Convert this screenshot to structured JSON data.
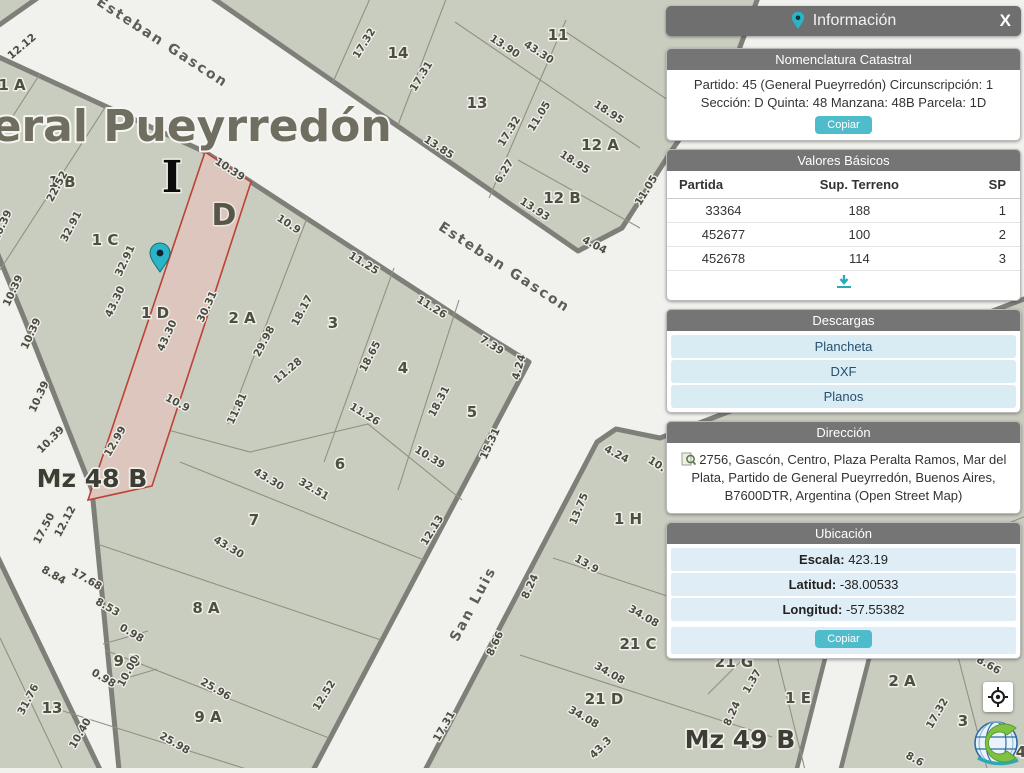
{
  "map": {
    "big_title": "General Pueyrredón",
    "section_marker_i": "I",
    "section_marker_d": "D",
    "street_esteban": "Esteban Gascon",
    "street_sanluis": "San Luis",
    "block_left": "Mz 48 B",
    "block_right": "Mz 49 B",
    "highlight_color": "#dcc6bd",
    "highlight_border": "#bb4237",
    "pin_color": "#2ab5c6",
    "labels": [
      {
        "t": "General Pueyrredón",
        "x": 143,
        "y": 141,
        "r": 0,
        "c": "big"
      },
      {
        "t": "I",
        "x": 172,
        "y": 192,
        "r": 0,
        "c": "roman"
      },
      {
        "t": "D",
        "x": 224,
        "y": 225,
        "r": 0,
        "c": "secd"
      },
      {
        "t": "Esteban Gascon",
        "x": 160,
        "y": 46,
        "r": 33,
        "c": "street"
      },
      {
        "t": "Esteban Gascon",
        "x": 502,
        "y": 271,
        "r": 33,
        "c": "street"
      },
      {
        "t": "San Luis",
        "x": 477,
        "y": 606,
        "r": -62,
        "c": "street"
      },
      {
        "t": "Mz 48 B",
        "x": 92,
        "y": 487,
        "r": 0,
        "c": "blk"
      },
      {
        "t": "Mz 49 B",
        "x": 740,
        "y": 748,
        "r": 0,
        "c": "blk"
      },
      {
        "t": "1 A",
        "x": 12,
        "y": 90,
        "r": 0,
        "c": "par"
      },
      {
        "t": "1 B",
        "x": 62,
        "y": 187,
        "r": 0,
        "c": "par"
      },
      {
        "t": "1 C",
        "x": 105,
        "y": 245,
        "r": 0,
        "c": "par"
      },
      {
        "t": "1 D",
        "x": 155,
        "y": 318,
        "r": 0,
        "c": "par"
      },
      {
        "t": "2 A",
        "x": 242,
        "y": 323,
        "r": 0,
        "c": "par"
      },
      {
        "t": "3",
        "x": 333,
        "y": 328,
        "r": 0,
        "c": "par"
      },
      {
        "t": "4",
        "x": 403,
        "y": 373,
        "r": 0,
        "c": "par"
      },
      {
        "t": "5",
        "x": 472,
        "y": 417,
        "r": 0,
        "c": "par"
      },
      {
        "t": "6",
        "x": 340,
        "y": 469,
        "r": 0,
        "c": "par"
      },
      {
        "t": "7",
        "x": 254,
        "y": 525,
        "r": 0,
        "c": "par"
      },
      {
        "t": "8 A",
        "x": 206,
        "y": 613,
        "r": 0,
        "c": "par"
      },
      {
        "t": "9 B",
        "x": 127,
        "y": 666,
        "r": 0,
        "c": "par"
      },
      {
        "t": "9 A",
        "x": 208,
        "y": 722,
        "r": 0,
        "c": "par"
      },
      {
        "t": "13",
        "x": 52,
        "y": 713,
        "r": 0,
        "c": "par"
      },
      {
        "t": "14",
        "x": 398,
        "y": 58,
        "r": 0,
        "c": "par"
      },
      {
        "t": "13",
        "x": 477,
        "y": 108,
        "r": 0,
        "c": "par"
      },
      {
        "t": "11",
        "x": 558,
        "y": 40,
        "r": 0,
        "c": "par"
      },
      {
        "t": "12 A",
        "x": 600,
        "y": 150,
        "r": 0,
        "c": "par"
      },
      {
        "t": "12 B",
        "x": 562,
        "y": 203,
        "r": 0,
        "c": "par"
      },
      {
        "t": "1 H",
        "x": 628,
        "y": 524,
        "r": 0,
        "c": "par"
      },
      {
        "t": "21 C",
        "x": 638,
        "y": 649,
        "r": 0,
        "c": "par"
      },
      {
        "t": "21 G",
        "x": 734,
        "y": 667,
        "r": 0,
        "c": "par"
      },
      {
        "t": "21 D",
        "x": 604,
        "y": 704,
        "r": 0,
        "c": "par"
      },
      {
        "t": "1 E",
        "x": 798,
        "y": 703,
        "r": 0,
        "c": "par"
      },
      {
        "t": "2 A",
        "x": 902,
        "y": 686,
        "r": 0,
        "c": "par"
      },
      {
        "t": "3",
        "x": 963,
        "y": 726,
        "r": 0,
        "c": "par"
      },
      {
        "t": "4",
        "x": 1021,
        "y": 757,
        "r": 0,
        "c": "par"
      },
      {
        "t": "12.12",
        "x": 24,
        "y": 49,
        "r": -40,
        "c": "dim"
      },
      {
        "t": "10.39",
        "x": 228,
        "y": 172,
        "r": 33,
        "c": "dim"
      },
      {
        "t": "10.9",
        "x": 287,
        "y": 227,
        "r": 33,
        "c": "dim"
      },
      {
        "t": "10.39",
        "x": 5,
        "y": 227,
        "r": -65,
        "c": "dim"
      },
      {
        "t": "10.39",
        "x": 16,
        "y": 292,
        "r": -65,
        "c": "dim"
      },
      {
        "t": "10.39",
        "x": 34,
        "y": 335,
        "r": -65,
        "c": "dim"
      },
      {
        "t": "10.39",
        "x": 42,
        "y": 398,
        "r": -65,
        "c": "dim"
      },
      {
        "t": "10.39",
        "x": 53,
        "y": 442,
        "r": -45,
        "c": "dim"
      },
      {
        "t": "22.52",
        "x": 60,
        "y": 188,
        "r": -62,
        "c": "dim"
      },
      {
        "t": "32.91",
        "x": 74,
        "y": 228,
        "r": -62,
        "c": "dim"
      },
      {
        "t": "32.91",
        "x": 128,
        "y": 262,
        "r": -65,
        "c": "dim"
      },
      {
        "t": "43.30",
        "x": 118,
        "y": 303,
        "r": -65,
        "c": "dim"
      },
      {
        "t": "43.30",
        "x": 170,
        "y": 337,
        "r": -65,
        "c": "dim"
      },
      {
        "t": "30.31",
        "x": 210,
        "y": 308,
        "r": -65,
        "c": "dim"
      },
      {
        "t": "12.99",
        "x": 118,
        "y": 443,
        "r": -60,
        "c": "dim"
      },
      {
        "t": "18.17",
        "x": 305,
        "y": 312,
        "r": -62,
        "c": "dim"
      },
      {
        "t": "29.98",
        "x": 267,
        "y": 343,
        "r": -62,
        "c": "dim"
      },
      {
        "t": "11.28",
        "x": 290,
        "y": 373,
        "r": -40,
        "c": "dim"
      },
      {
        "t": "11.81",
        "x": 240,
        "y": 410,
        "r": -65,
        "c": "dim"
      },
      {
        "t": "10.9",
        "x": 176,
        "y": 406,
        "r": 28,
        "c": "dim"
      },
      {
        "t": "11.25",
        "x": 362,
        "y": 266,
        "r": 32,
        "c": "dim"
      },
      {
        "t": "11.26",
        "x": 430,
        "y": 310,
        "r": 32,
        "c": "dim"
      },
      {
        "t": "11.26",
        "x": 363,
        "y": 417,
        "r": 32,
        "c": "dim"
      },
      {
        "t": "18.65",
        "x": 373,
        "y": 358,
        "r": -62,
        "c": "dim"
      },
      {
        "t": "18.31",
        "x": 442,
        "y": 403,
        "r": -62,
        "c": "dim"
      },
      {
        "t": "7.39",
        "x": 490,
        "y": 348,
        "r": 32,
        "c": "dim"
      },
      {
        "t": "4.24",
        "x": 522,
        "y": 368,
        "r": -75,
        "c": "dim"
      },
      {
        "t": "15.31",
        "x": 493,
        "y": 445,
        "r": -65,
        "c": "dim"
      },
      {
        "t": "10.39",
        "x": 428,
        "y": 460,
        "r": 32,
        "c": "dim"
      },
      {
        "t": "17.32",
        "x": 367,
        "y": 45,
        "r": -58,
        "c": "dim"
      },
      {
        "t": "17.31",
        "x": 424,
        "y": 78,
        "r": -58,
        "c": "dim"
      },
      {
        "t": "13.90",
        "x": 503,
        "y": 49,
        "r": 33,
        "c": "dim"
      },
      {
        "t": "43.30",
        "x": 537,
        "y": 55,
        "r": 33,
        "c": "dim"
      },
      {
        "t": "13.85",
        "x": 437,
        "y": 150,
        "r": 33,
        "c": "dim"
      },
      {
        "t": "17.32",
        "x": 512,
        "y": 133,
        "r": -58,
        "c": "dim"
      },
      {
        "t": "11.05",
        "x": 542,
        "y": 118,
        "r": -58,
        "c": "dim"
      },
      {
        "t": "18.95",
        "x": 607,
        "y": 115,
        "r": 33,
        "c": "dim"
      },
      {
        "t": "18.95",
        "x": 573,
        "y": 165,
        "r": 33,
        "c": "dim"
      },
      {
        "t": "6.27",
        "x": 507,
        "y": 173,
        "r": -58,
        "c": "dim"
      },
      {
        "t": "13.93",
        "x": 533,
        "y": 212,
        "r": 33,
        "c": "dim"
      },
      {
        "t": "4.04",
        "x": 593,
        "y": 248,
        "r": 28,
        "c": "dim"
      },
      {
        "t": "11.05",
        "x": 649,
        "y": 192,
        "r": -58,
        "c": "dim"
      },
      {
        "t": "43.30",
        "x": 267,
        "y": 482,
        "r": 31,
        "c": "dim"
      },
      {
        "t": "32.51",
        "x": 312,
        "y": 492,
        "r": 31,
        "c": "dim"
      },
      {
        "t": "43.30",
        "x": 227,
        "y": 550,
        "r": 31,
        "c": "dim"
      },
      {
        "t": "17.50",
        "x": 47,
        "y": 530,
        "r": -62,
        "c": "dim"
      },
      {
        "t": "12.12",
        "x": 68,
        "y": 523,
        "r": -62,
        "c": "dim"
      },
      {
        "t": "8.84",
        "x": 52,
        "y": 578,
        "r": 30,
        "c": "dim"
      },
      {
        "t": "17.68",
        "x": 85,
        "y": 582,
        "r": 30,
        "c": "dim"
      },
      {
        "t": "8.53",
        "x": 106,
        "y": 610,
        "r": 30,
        "c": "dim"
      },
      {
        "t": "0.98",
        "x": 130,
        "y": 636,
        "r": 30,
        "c": "dim"
      },
      {
        "t": "0.98",
        "x": 102,
        "y": 681,
        "r": 30,
        "c": "dim"
      },
      {
        "t": "10.00",
        "x": 131,
        "y": 673,
        "r": -62,
        "c": "dim"
      },
      {
        "t": "25.96",
        "x": 214,
        "y": 692,
        "r": 30,
        "c": "dim"
      },
      {
        "t": "25.98",
        "x": 173,
        "y": 746,
        "r": 30,
        "c": "dim"
      },
      {
        "t": "31.76",
        "x": 31,
        "y": 701,
        "r": -62,
        "c": "dim"
      },
      {
        "t": "10.40",
        "x": 83,
        "y": 735,
        "r": -60,
        "c": "dim"
      },
      {
        "t": "12.52",
        "x": 327,
        "y": 697,
        "r": -58,
        "c": "dim"
      },
      {
        "t": "12.13",
        "x": 435,
        "y": 532,
        "r": -58,
        "c": "dim"
      },
      {
        "t": "17.31",
        "x": 447,
        "y": 728,
        "r": -60,
        "c": "dim"
      },
      {
        "t": "4.24",
        "x": 615,
        "y": 457,
        "r": 28,
        "c": "dim"
      },
      {
        "t": "10.",
        "x": 655,
        "y": 467,
        "r": 33,
        "c": "dim"
      },
      {
        "t": "13.75",
        "x": 582,
        "y": 510,
        "r": -68,
        "c": "dim"
      },
      {
        "t": "13.9",
        "x": 585,
        "y": 567,
        "r": 30,
        "c": "dim"
      },
      {
        "t": "34.08",
        "x": 642,
        "y": 619,
        "r": 30,
        "c": "dim"
      },
      {
        "t": "34.08",
        "x": 608,
        "y": 676,
        "r": 30,
        "c": "dim"
      },
      {
        "t": "34.08",
        "x": 582,
        "y": 720,
        "r": 30,
        "c": "dim"
      },
      {
        "t": "17.32",
        "x": 791,
        "y": 625,
        "r": -60,
        "c": "dim"
      },
      {
        "t": "1.37",
        "x": 755,
        "y": 683,
        "r": -60,
        "c": "dim"
      },
      {
        "t": "8.24",
        "x": 533,
        "y": 588,
        "r": -65,
        "c": "dim"
      },
      {
        "t": "8.24",
        "x": 735,
        "y": 715,
        "r": -65,
        "c": "dim"
      },
      {
        "t": "8.66",
        "x": 498,
        "y": 645,
        "r": -65,
        "c": "dim"
      },
      {
        "t": "43.3",
        "x": 603,
        "y": 750,
        "r": -45,
        "c": "dim"
      },
      {
        "t": "17.32",
        "x": 940,
        "y": 715,
        "r": -60,
        "c": "dim"
      },
      {
        "t": "8.66",
        "x": 987,
        "y": 668,
        "r": 30,
        "c": "dim"
      },
      {
        "t": "8.6",
        "x": 913,
        "y": 762,
        "r": 30,
        "c": "dim"
      }
    ],
    "pin": {
      "x": 160,
      "y": 272
    }
  },
  "panel": {
    "title": "Información",
    "close_label": "X",
    "nomenclatura": {
      "header": "Nomenclatura Catastral",
      "text": "Partido: 45 (General Pueyrredón) Circunscripción: 1 Sección: D Quinta: 48 Manzana: 48B Parcela: 1D",
      "copy_label": "Copiar"
    },
    "valores": {
      "header": "Valores Básicos",
      "cols": [
        "Partida",
        "Sup. Terreno",
        "SP"
      ],
      "rows": [
        [
          "33364",
          "188",
          "1"
        ],
        [
          "452677",
          "100",
          "2"
        ],
        [
          "452678",
          "114",
          "3"
        ]
      ]
    },
    "descargas": {
      "header": "Descargas",
      "items": [
        "Plancheta",
        "DXF",
        "Planos"
      ]
    },
    "direccion": {
      "header": "Dirección",
      "text": "2756, Gascón, Centro, Plaza Peralta Ramos, Mar del Plata, Partido de General Pueyrredón, Buenos Aires, B7600DTR, Argentina (Open Street Map)"
    },
    "ubicacion": {
      "header": "Ubicación",
      "rows": [
        {
          "label": "Escala:",
          "value": "423.19"
        },
        {
          "label": "Latitud:",
          "value": "-38.00533"
        },
        {
          "label": "Longitud:",
          "value": "-57.55382"
        }
      ],
      "copy_label": "Copiar"
    },
    "accent_color": "#4fbccb",
    "header_color": "#6f6f6f",
    "row_color": "#d9ecf4"
  }
}
